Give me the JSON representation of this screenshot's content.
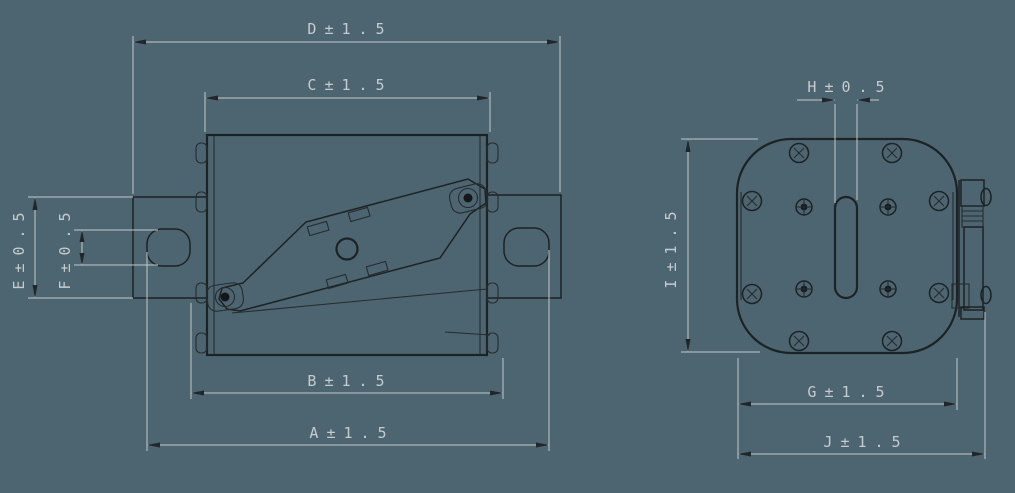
{
  "drawing": {
    "kind": "technical-drawing",
    "part": "fuse-link-two-views",
    "dimensions": {
      "D": "D±1.5",
      "C": "C±1.5",
      "B": "B±1.5",
      "A": "A±1.5",
      "E": "E±0.5",
      "F": "F±0.5",
      "H": "H±0.5",
      "I": "I±1.5",
      "G": "G±1.5",
      "J": "J±1.5"
    },
    "tolerances": {
      "large": "±1.5",
      "small": "±0.5"
    },
    "colors": {
      "background": "#4d6570",
      "geometry_line": "#1d2224",
      "dimension_line": "#c3c9ca",
      "dimension_text": "#c6cbcd",
      "arrowhead": "#20262a"
    }
  }
}
